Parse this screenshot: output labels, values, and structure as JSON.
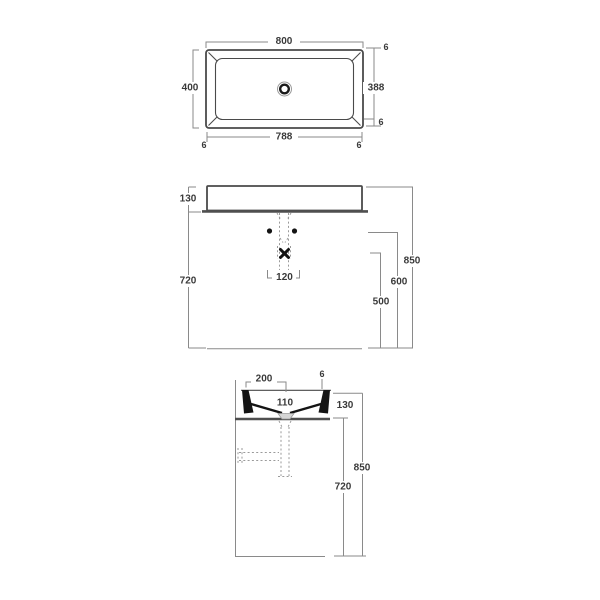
{
  "colors": {
    "outline": "#4a4a4a",
    "dimension_line": "#8a8a8a",
    "dashed_pipe": "#9a9a9a",
    "solid_black": "#141414",
    "background": "#ffffff"
  },
  "plan": {
    "width": "800",
    "depth": "400",
    "inner_depth": "388",
    "inner_width": "788",
    "rim_right_top": "6",
    "rim_right_bottom": "6",
    "rim_bottom_left": "6",
    "rim_bottom_right": "6"
  },
  "front": {
    "basin_height": "130",
    "stand_height": "720",
    "total_height": "850",
    "faucet_height": "600",
    "outlet_height": "500",
    "drain_offset": "120"
  },
  "side": {
    "edge_to_drain": "200",
    "inner_depth": "110",
    "rim": "6",
    "basin_height": "130",
    "total_height": "850",
    "stand_height": "720"
  }
}
